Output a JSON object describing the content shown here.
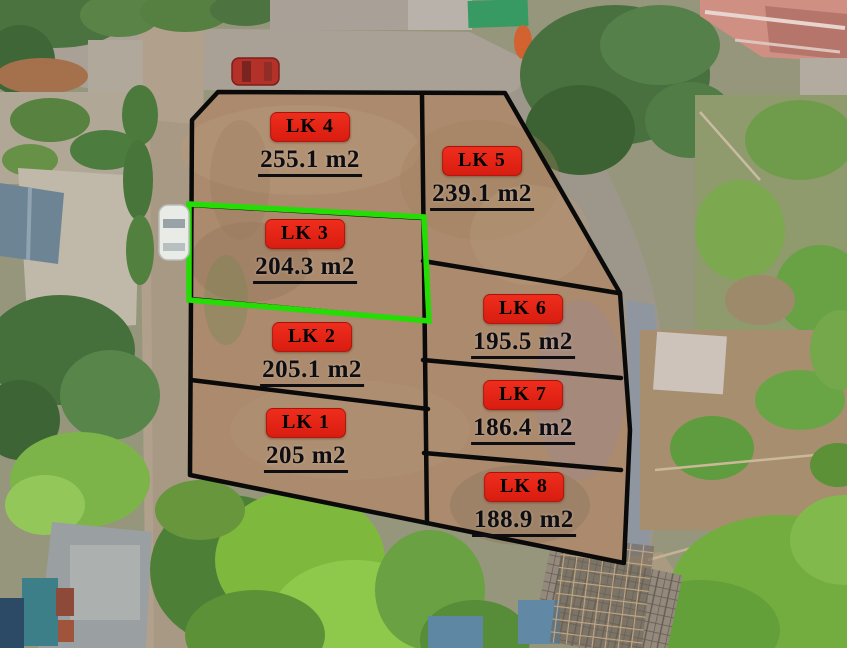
{
  "map": {
    "highlighted_plot": "LK 3",
    "plots": [
      {
        "code": "LK 1",
        "area": "205 m2",
        "highlighted": false
      },
      {
        "code": "LK 2",
        "area": "205.1 m2",
        "highlighted": false
      },
      {
        "code": "LK 3",
        "area": "204.3 m2",
        "highlighted": true
      },
      {
        "code": "LK 4",
        "area": "255.1 m2",
        "highlighted": false
      },
      {
        "code": "LK 5",
        "area": "239.1 m2",
        "highlighted": false
      },
      {
        "code": "LK 6",
        "area": "195.5 m2",
        "highlighted": false
      },
      {
        "code": "LK 7",
        "area": "186.4 m2",
        "highlighted": false
      },
      {
        "code": "LK 8",
        "area": "188.9 m2",
        "highlighted": false
      }
    ]
  },
  "colors": {
    "label_background": "#ef2d1d",
    "label_background_dark": "#d81d10",
    "label_text": "#000000",
    "area_text": "#0d0d12",
    "boundary_line": "#0a0a0a",
    "highlight_outline": "#24dd04"
  }
}
